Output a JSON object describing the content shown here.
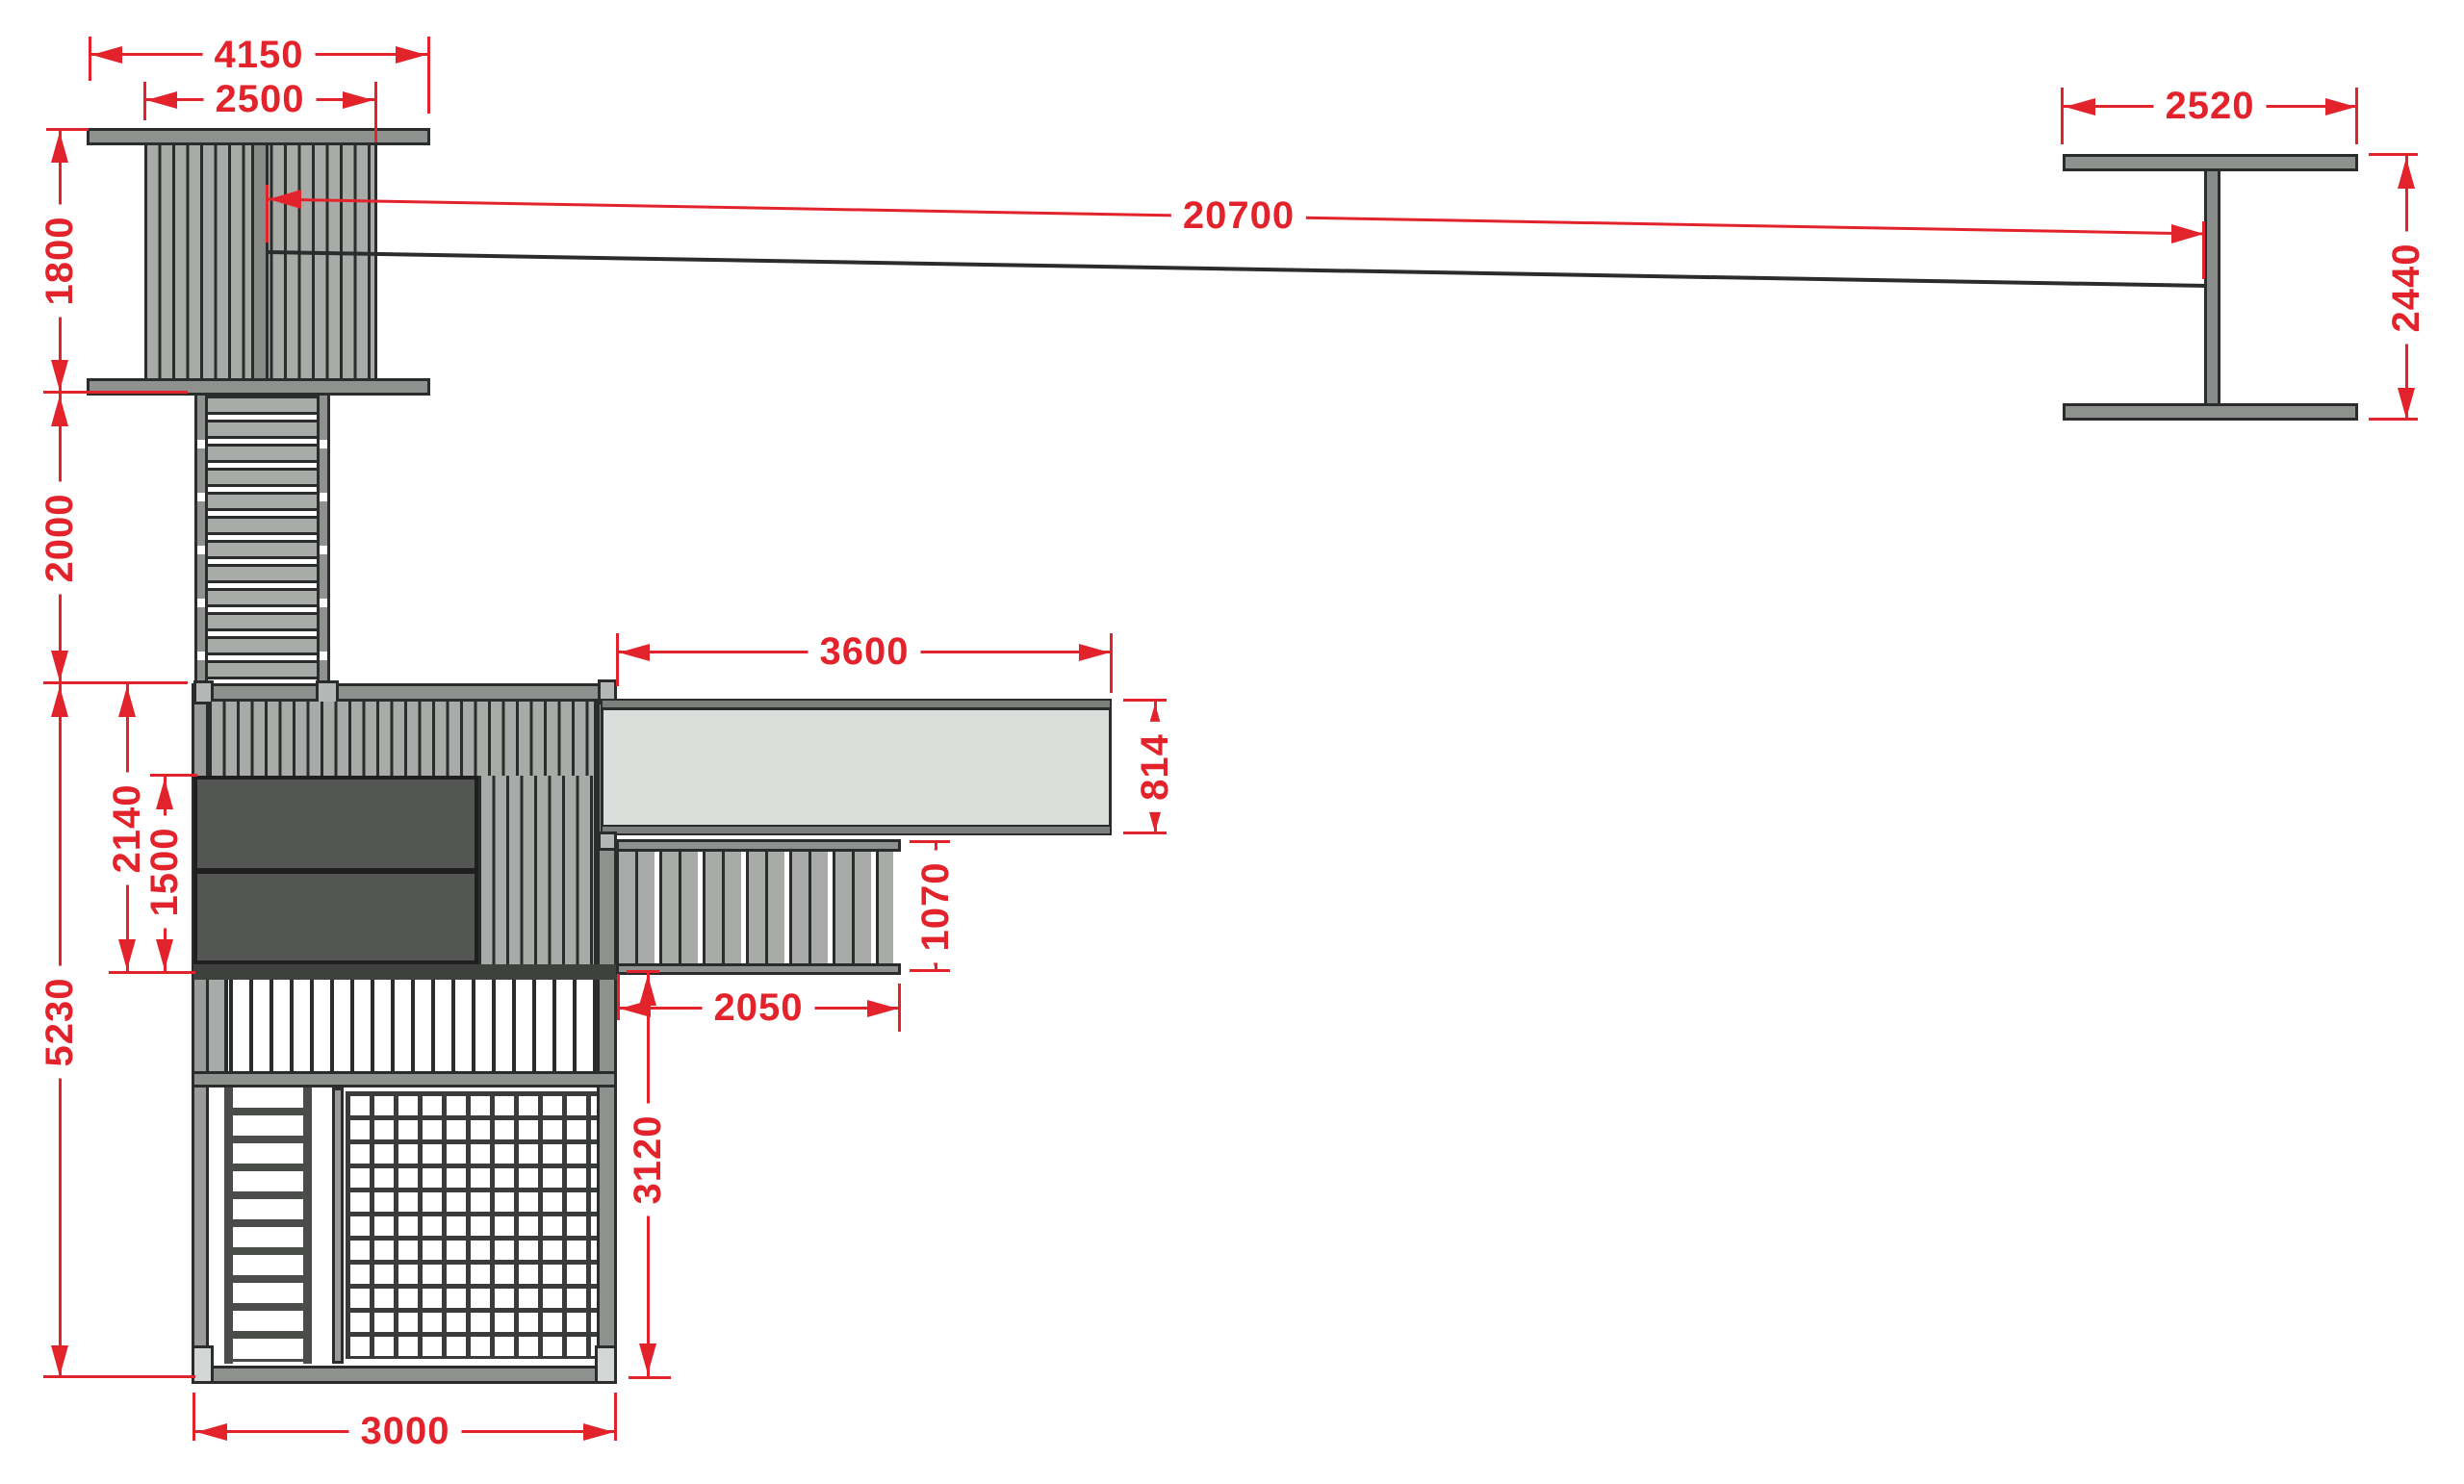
{
  "drawing": {
    "title": "Playground zipline structure - plan view",
    "unit": "mm",
    "accent_color": "#e3232b",
    "outline_color": "#2b2d2c",
    "dimensions": {
      "tower_overall_width": "4150",
      "tower_roof_width": "2500",
      "tower_depth": "1800",
      "bridge_length": "2000",
      "cable_span": "20700",
      "end_support_width": "2520",
      "end_support_depth": "2440",
      "platform_upper_depth": "2140",
      "platform_panel_depth": "1500",
      "platform_total_depth": "5230",
      "slide_length": "3600",
      "slide_width": "814",
      "stairs_depth": "1070",
      "stairs_length": "2050",
      "lower_section_depth": "3120",
      "platform_width": "3000"
    }
  }
}
